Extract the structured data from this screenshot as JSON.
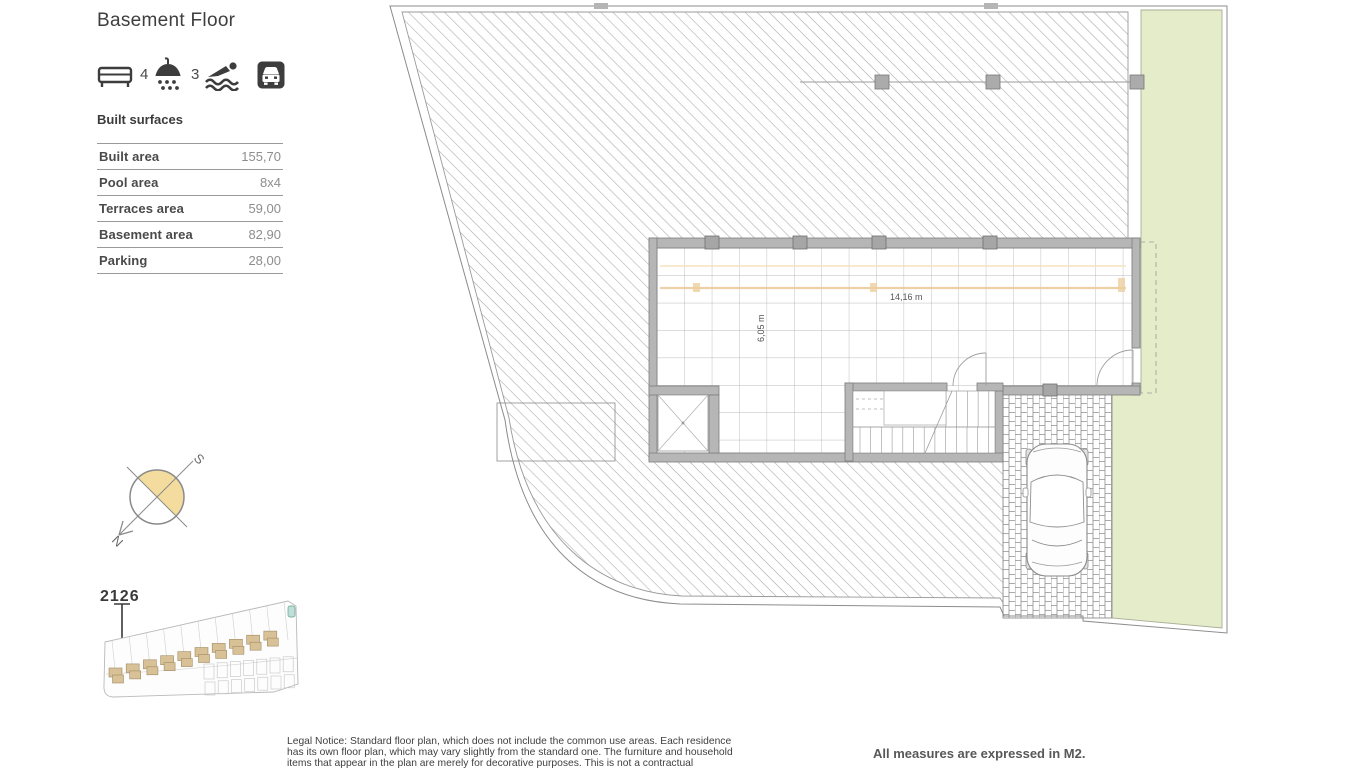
{
  "sidebar": {
    "title": "Basement Floor",
    "features": {
      "bedrooms": "4",
      "bathrooms": "3"
    },
    "built_surfaces": {
      "heading": "Built surfaces",
      "rows": [
        {
          "label": "Built area",
          "value": "155,70"
        },
        {
          "label": "Pool area",
          "value": "8x4"
        },
        {
          "label": "Terraces area",
          "value": "59,00"
        },
        {
          "label": "Basement area",
          "value": "82,90"
        },
        {
          "label": "Parking",
          "value": "28,00"
        }
      ]
    },
    "compass": {
      "north_label": "N",
      "south_label": "S"
    },
    "siteplan": {
      "unit_number": "2126"
    }
  },
  "plan": {
    "dimensions": {
      "width_label": "14,16 m",
      "height_label": "6,05 m"
    },
    "colors": {
      "garden": "#e5ecc9",
      "wall": "#b6b6b6",
      "hatch_line": "#a9a9a9",
      "beam": "#ecc897",
      "compass_fill": "#f3dc9e",
      "house_fill": "#d8c097"
    }
  },
  "footer": {
    "legal_notice": "Legal Notice: Standard floor plan, which does not include the common use areas. Each residence has its own floor plan, which may vary slightly from the standard one. The furniture and household items that appear in the plan are merely for decorative purposes. This is not a contractual document. This plan can",
    "measures_note": "All measures are expressed in M2."
  }
}
